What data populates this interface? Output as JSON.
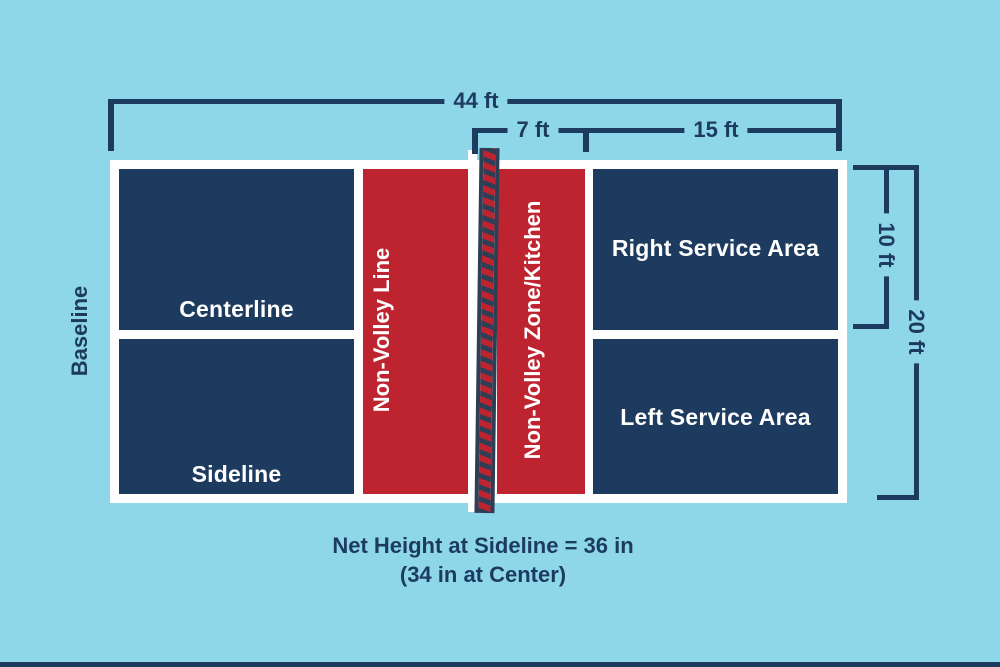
{
  "diagram": {
    "court_labels": {
      "baseline": "Baseline",
      "centerline": "Centerline",
      "sideline": "Sideline",
      "non_volley_line": "Non-Volley Line",
      "non_volley_zone": "Non-Volley Zone/Kitchen",
      "right_service_area": "Right Service Area",
      "left_service_area": "Left Service Area"
    },
    "dimensions": {
      "overall_length": "44 ft",
      "non_volley_depth": "7 ft",
      "service_area_length": "15 ft",
      "half_width": "10 ft",
      "full_width": "20 ft"
    },
    "net_note": {
      "line1": "Net Height at Sideline = 36 in",
      "line2": "(34 in at Center)"
    },
    "colors": {
      "background": "#8DD7E8",
      "navy": "#1D3A5F",
      "red": "#BE2430",
      "white": "#FFFFFF",
      "net_dark": "#2F3E55"
    }
  }
}
